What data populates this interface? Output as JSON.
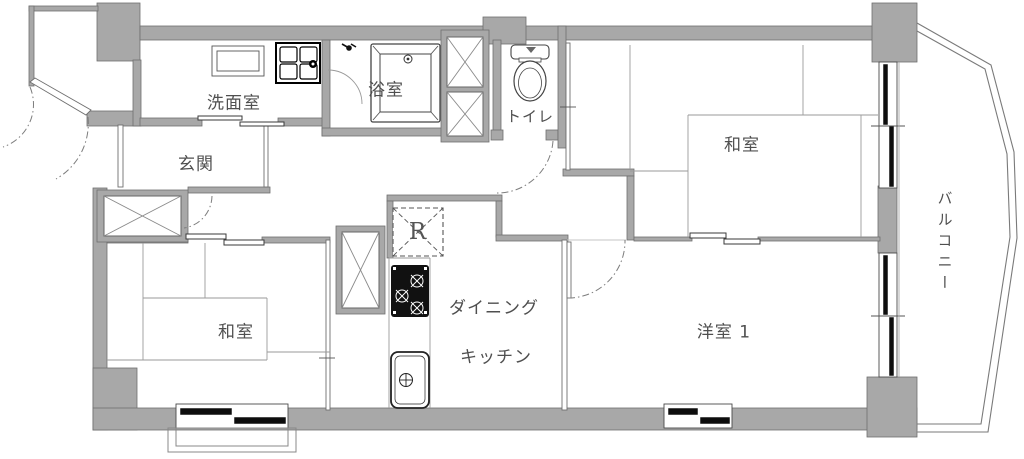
{
  "plan": {
    "type": "apartment-floor-plan",
    "labels": {
      "washroom": "洗面室",
      "bathroom": "浴室",
      "toilet": "トイレ",
      "entrance": "玄関",
      "japanese_room_1": "和室",
      "japanese_room_2": "和室",
      "dining": "ダイニング",
      "kitchen": "キッチン",
      "western_room": "洋室 1",
      "balcony": "バルコニー",
      "refrigerator": "R"
    },
    "colors": {
      "wall_fill": "#a8a8a8",
      "wall_stroke": "#6f6f6f",
      "line": "#8a8a8a",
      "dark_line": "#444444",
      "fixture_black": "#111111",
      "text": "#4f4f4f",
      "background": "#ffffff"
    }
  }
}
